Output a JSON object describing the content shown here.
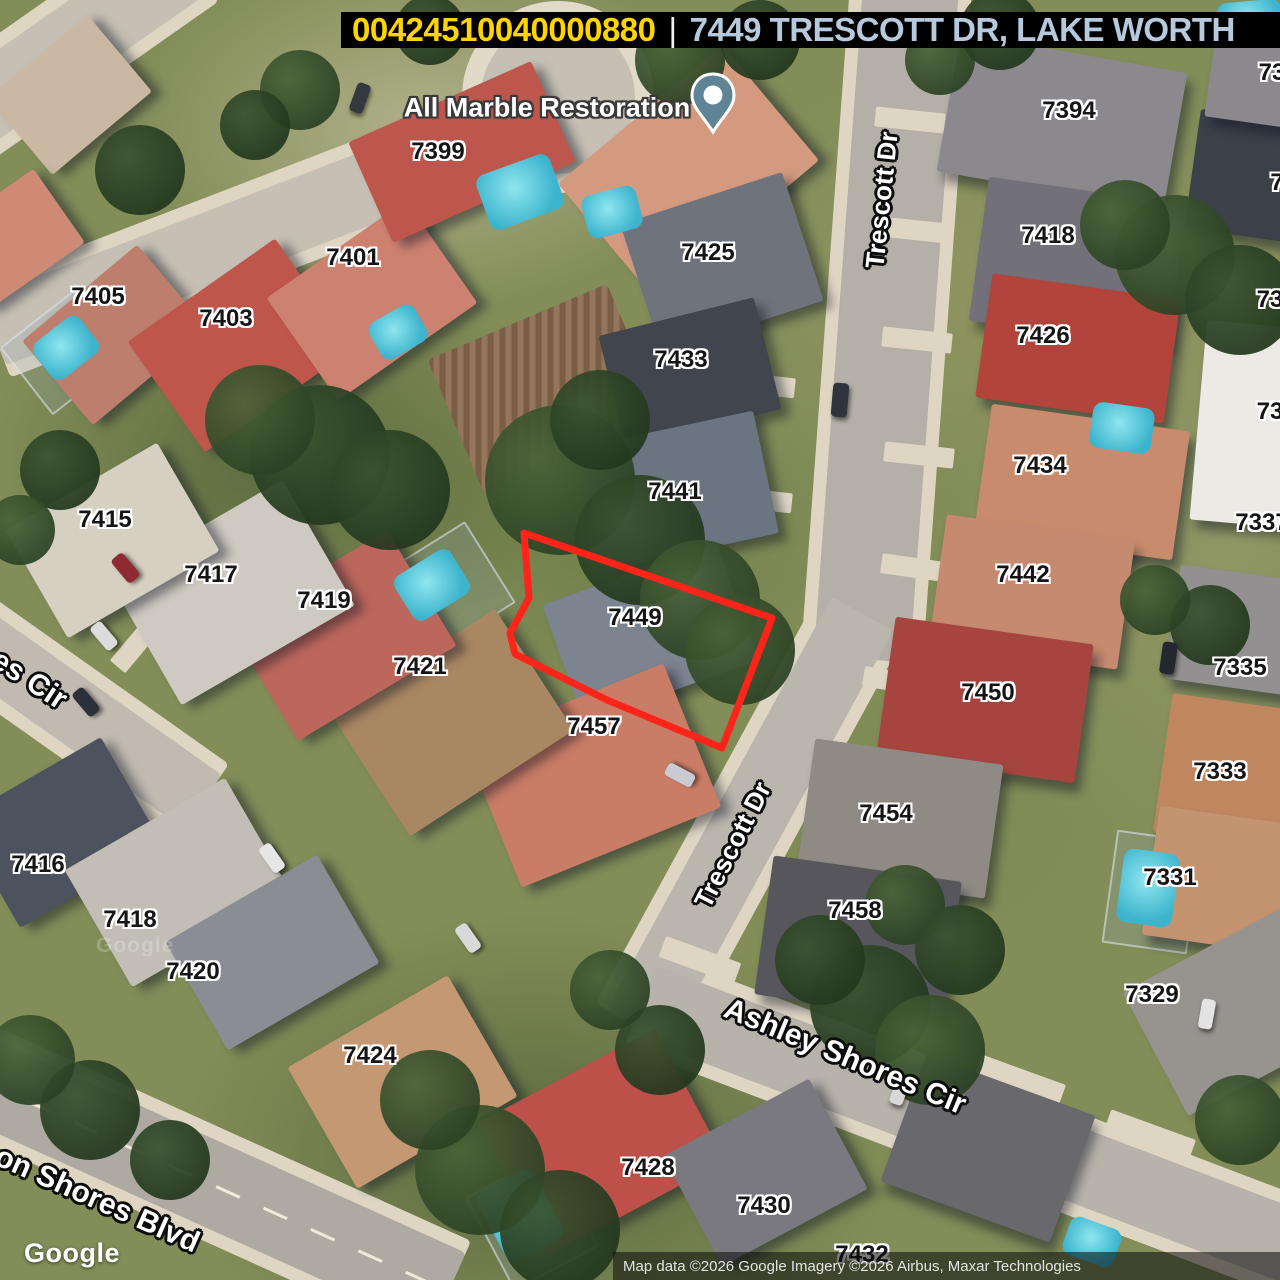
{
  "header": {
    "parcel_id": "00424510040000880",
    "separator": "|",
    "address": "7449 TRESCOTT DR, LAKE WORTH",
    "parcel_id_color": "#ffd400",
    "address_color": "#b7cadd",
    "bg_color": "#000000"
  },
  "poi": {
    "label": "All Marble Restoration",
    "pin_color": "#5f8496"
  },
  "parcel": {
    "number": "7449",
    "outline_color": "#ff2419",
    "outline_points": "524,533 772,618 722,748 607,700 515,654 510,633 529,598"
  },
  "map": {
    "house_labels": [
      {
        "t": "7399",
        "x": 438,
        "y": 152
      },
      {
        "t": "7401",
        "x": 353,
        "y": 258
      },
      {
        "t": "7403",
        "x": 226,
        "y": 319
      },
      {
        "t": "7405",
        "x": 98,
        "y": 297
      },
      {
        "t": "7415",
        "x": 105,
        "y": 520
      },
      {
        "t": "7417",
        "x": 211,
        "y": 575
      },
      {
        "t": "7419",
        "x": 324,
        "y": 601
      },
      {
        "t": "7421",
        "x": 420,
        "y": 667
      },
      {
        "t": "7416",
        "x": 38,
        "y": 865
      },
      {
        "t": "7418",
        "x": 130,
        "y": 920
      },
      {
        "t": "7420",
        "x": 193,
        "y": 972
      },
      {
        "t": "7424",
        "x": 370,
        "y": 1056
      },
      {
        "t": "7425",
        "x": 708,
        "y": 253
      },
      {
        "t": "7433",
        "x": 681,
        "y": 360
      },
      {
        "t": "7441",
        "x": 675,
        "y": 492
      },
      {
        "t": "7449",
        "x": 635,
        "y": 618
      },
      {
        "t": "7457",
        "x": 594,
        "y": 727
      },
      {
        "t": "7428",
        "x": 648,
        "y": 1168
      },
      {
        "t": "7430",
        "x": 764,
        "y": 1206
      },
      {
        "t": "7432",
        "x": 862,
        "y": 1255
      },
      {
        "t": "7394",
        "x": 1069,
        "y": 111
      },
      {
        "t": "7418",
        "x": 1048,
        "y": 236
      },
      {
        "t": "7426",
        "x": 1043,
        "y": 336
      },
      {
        "t": "7434",
        "x": 1040,
        "y": 466
      },
      {
        "t": "7442",
        "x": 1023,
        "y": 575
      },
      {
        "t": "7450",
        "x": 988,
        "y": 693
      },
      {
        "t": "7454",
        "x": 886,
        "y": 814
      },
      {
        "t": "7458",
        "x": 855,
        "y": 911
      },
      {
        "t": "7335",
        "x": 1240,
        "y": 668
      },
      {
        "t": "7333",
        "x": 1220,
        "y": 772
      },
      {
        "t": "7331",
        "x": 1170,
        "y": 878
      },
      {
        "t": "7329",
        "x": 1152,
        "y": 995
      },
      {
        "t": "73",
        "x": 1272,
        "y": 73
      },
      {
        "t": "7",
        "x": 1277,
        "y": 183
      },
      {
        "t": "73",
        "x": 1270,
        "y": 300
      },
      {
        "t": "73",
        "x": 1270,
        "y": 412
      },
      {
        "t": "7337",
        "x": 1262,
        "y": 523
      }
    ],
    "street_labels": [
      {
        "t": "Trescott Dr",
        "x": 882,
        "y": 200,
        "r": -84,
        "s": 26
      },
      {
        "t": "Trescott Dr",
        "x": 733,
        "y": 845,
        "r": -63,
        "s": 26
      },
      {
        "t": "Ashley Shores Cir",
        "x": 845,
        "y": 1057,
        "r": 22.5,
        "s": 30
      },
      {
        "t": "on Shores Blvd",
        "x": 97,
        "y": 1200,
        "r": 24,
        "s": 30
      },
      {
        "t": "es Cir",
        "x": 29,
        "y": 680,
        "r": 33,
        "s": 30
      }
    ]
  },
  "watermark": {
    "logo": "Google",
    "ghost": "Google"
  },
  "attribution": {
    "text": "Map data ©2026 Google Imagery ©2026 Airbus, Maxar Technologies"
  }
}
